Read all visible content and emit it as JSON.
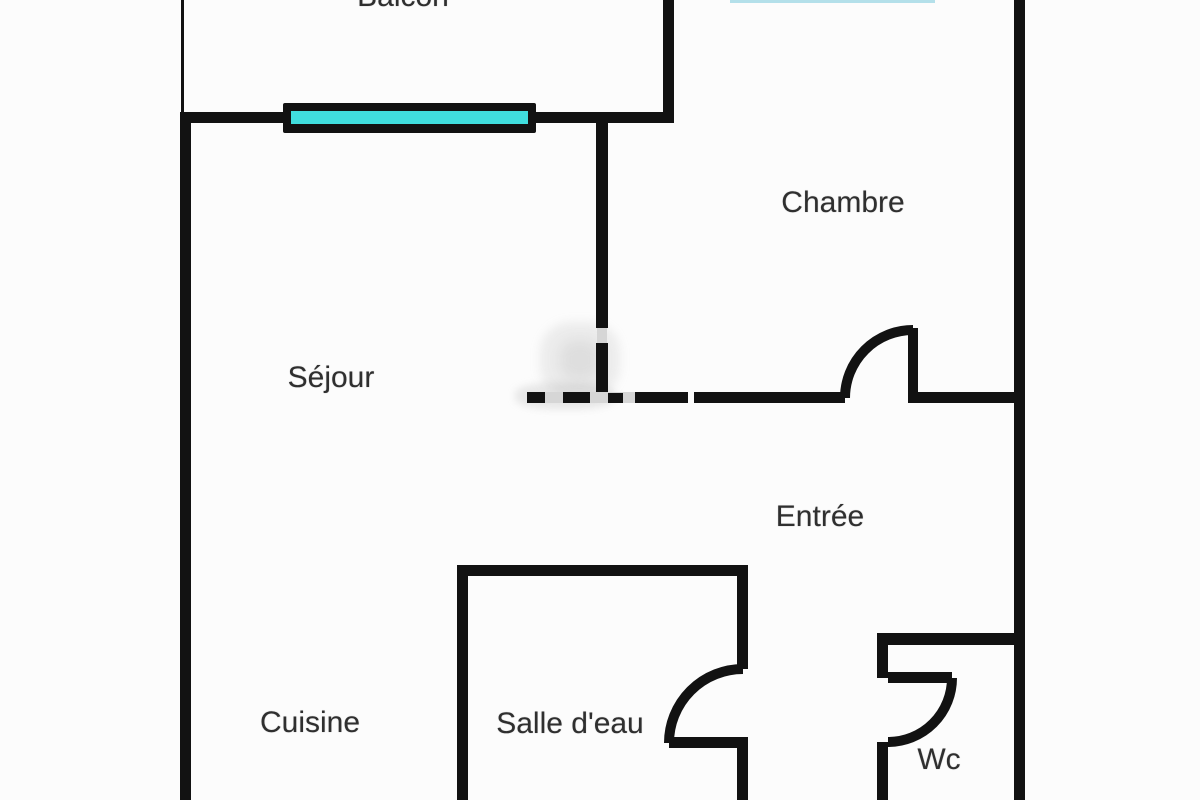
{
  "plan": {
    "type": "apartment-floor-plan",
    "rooms": [
      {
        "id": "balcon",
        "label": "Balcon"
      },
      {
        "id": "chambre",
        "label": "Chambre"
      },
      {
        "id": "sejour",
        "label": "Séjour"
      },
      {
        "id": "entree",
        "label": "Entrée"
      },
      {
        "id": "cuisine",
        "label": "Cuisine"
      },
      {
        "id": "salle-deau",
        "label": "Salle d'eau"
      },
      {
        "id": "wc",
        "label": "Wc"
      }
    ],
    "features": {
      "windows": [
        "balcony-window"
      ],
      "doors": [
        "chambre-door",
        "salle-deau-door",
        "wc-door"
      ]
    },
    "colors": {
      "wall": "#121212",
      "window_glass": "#40dede",
      "text": "#2f2f2f",
      "background": "#fcfcfc"
    }
  }
}
